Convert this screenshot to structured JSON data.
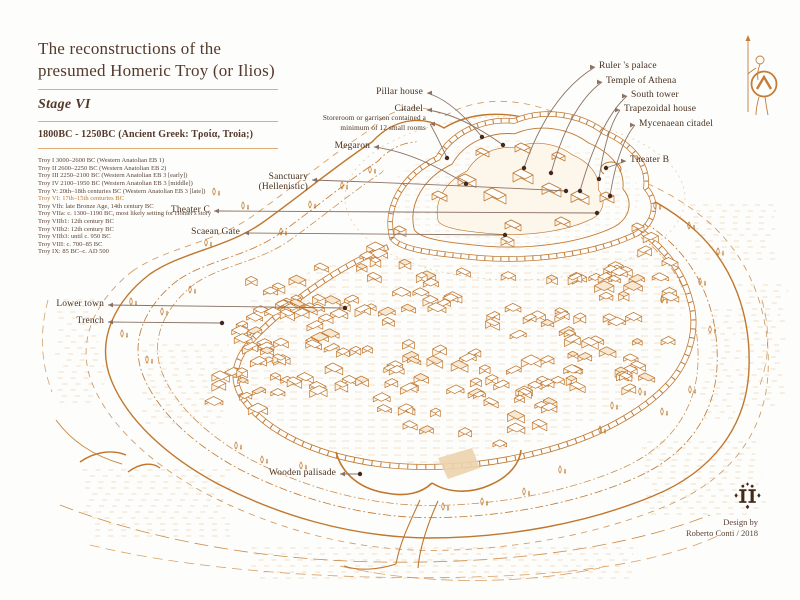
{
  "palette": {
    "background": "#fdfdfb",
    "ink_orange": "#c0772e",
    "ink_brown": "#48301f",
    "leader_line": "#8b7264",
    "divider": "#e0ad79",
    "highlight": "#c0772e",
    "credit_brown": "#5c4335"
  },
  "header": {
    "title_line1": "The reconstructions of the",
    "title_line2": "presumed Homeric Troy (or Ilios)",
    "stage": "Stage VI",
    "period": "1800BC - 1250BC (Ancient Greek: Τροία, Troia;)",
    "timeline": [
      {
        "text": "Troy I 3000–2600 BC (Western Anatolian EB 1)",
        "highlight": false
      },
      {
        "text": "Troy II 2600–2250 BC (Western Anatolian EB 2)",
        "highlight": false
      },
      {
        "text": "Troy III 2250–2100 BC (Western Anatolian EB 3 [early])",
        "highlight": false
      },
      {
        "text": "Troy IV 2100–1950 BC (Western Anatolian EB 3 [middle])",
        "highlight": false
      },
      {
        "text": "Troy V: 20th–18th centuries BC (Western Anatolian EB 3 [late])",
        "highlight": false
      },
      {
        "text": "Troy VI: 17th–15th centuries BC",
        "highlight": true
      },
      {
        "text": "Troy VIh: late Bronze Age, 14th century BC",
        "highlight": false
      },
      {
        "text": "Troy VIIa: c. 1300–1190 BC, most likely setting for Homer's story",
        "highlight": false
      },
      {
        "text": "Troy VIIb1: 12th century BC",
        "highlight": false
      },
      {
        "text": "Troy VIIb2: 12th century BC",
        "highlight": false
      },
      {
        "text": "Troy VIIb3: until c. 950 BC",
        "highlight": false
      },
      {
        "text": "Troy VIII: c. 700–85 BC",
        "highlight": false
      },
      {
        "text": "Troy IX: 85 BC–c. AD 500",
        "highlight": false
      }
    ]
  },
  "labels": {
    "pillar_house": "Pillar house",
    "citadel": "Citadel",
    "storeroom_line1": "Storeroom or garrison contained a",
    "storeroom_line2": "minimum of 12 small rooms",
    "megaron": "Megaron",
    "rulers_palace": "Ruler 's palace",
    "temple_of_athena": "Temple of Athena",
    "south_tower": "South tower",
    "trapezoidal_house": "Trapezoidal house",
    "mycenaean_citadel": "Mycenaean citadel",
    "theater_b": "Theater B",
    "sanctuary_line1": "Sanctuary",
    "sanctuary_line2": "(Hellenistic)",
    "theater_c": "Theater C",
    "scaean_gate": "Scaean Gate",
    "lower_town": "Lower town",
    "trench": "Trench",
    "wooden_palisade": "Wooden palisade"
  },
  "credits": {
    "design_by": "Design by",
    "author": "Roberto Conti / 2018"
  },
  "icons": {
    "warrior_icon": "greek-warrior-with-spear-and-lambda-shield",
    "monogram_icon": "designer-ii-monogram"
  }
}
